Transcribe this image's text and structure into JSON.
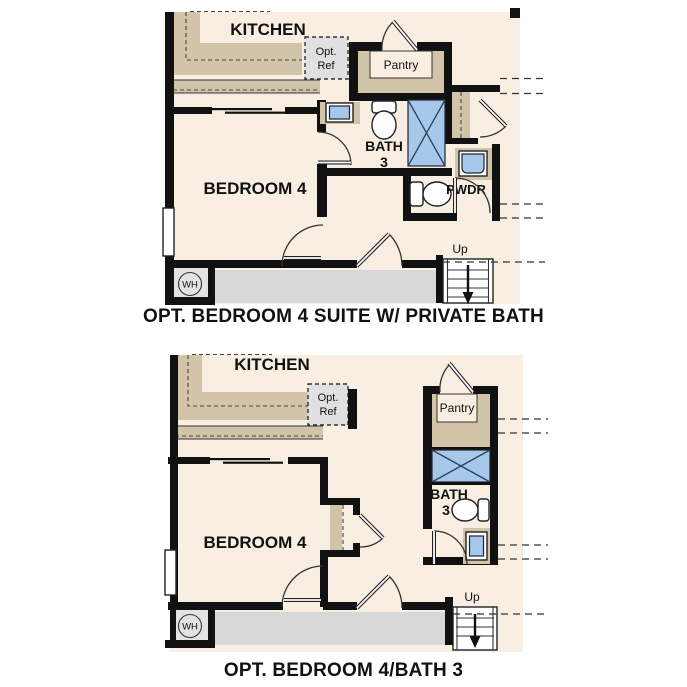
{
  "colors": {
    "floor": "#f8efe2",
    "counter": "#d2c4a8",
    "wall": "#111111",
    "fixture_blue": "#a6c8ea",
    "hall": "#d8d8d8",
    "optref": "#e0e0e0"
  },
  "plans": [
    {
      "title": "OPT. BEDROOM 4 SUITE W/ PRIVATE BATH",
      "labels": {
        "kitchen": "KITCHEN",
        "opt_ref_l1": "Opt.",
        "opt_ref_l2": "Ref",
        "pantry": "Pantry",
        "bath_l1": "BATH",
        "bath_l2": "3",
        "bedroom": "BEDROOM 4",
        "powder": "PWDR",
        "up": "Up",
        "wh": "WH"
      }
    },
    {
      "title": "OPT. BEDROOM 4/BATH 3",
      "labels": {
        "kitchen": "KITCHEN",
        "opt_ref_l1": "Opt.",
        "opt_ref_l2": "Ref",
        "pantry": "Pantry",
        "bath_l1": "BATH",
        "bath_l2": "3",
        "bedroom": "BEDROOM 4",
        "up": "Up",
        "wh": "WH"
      }
    }
  ]
}
